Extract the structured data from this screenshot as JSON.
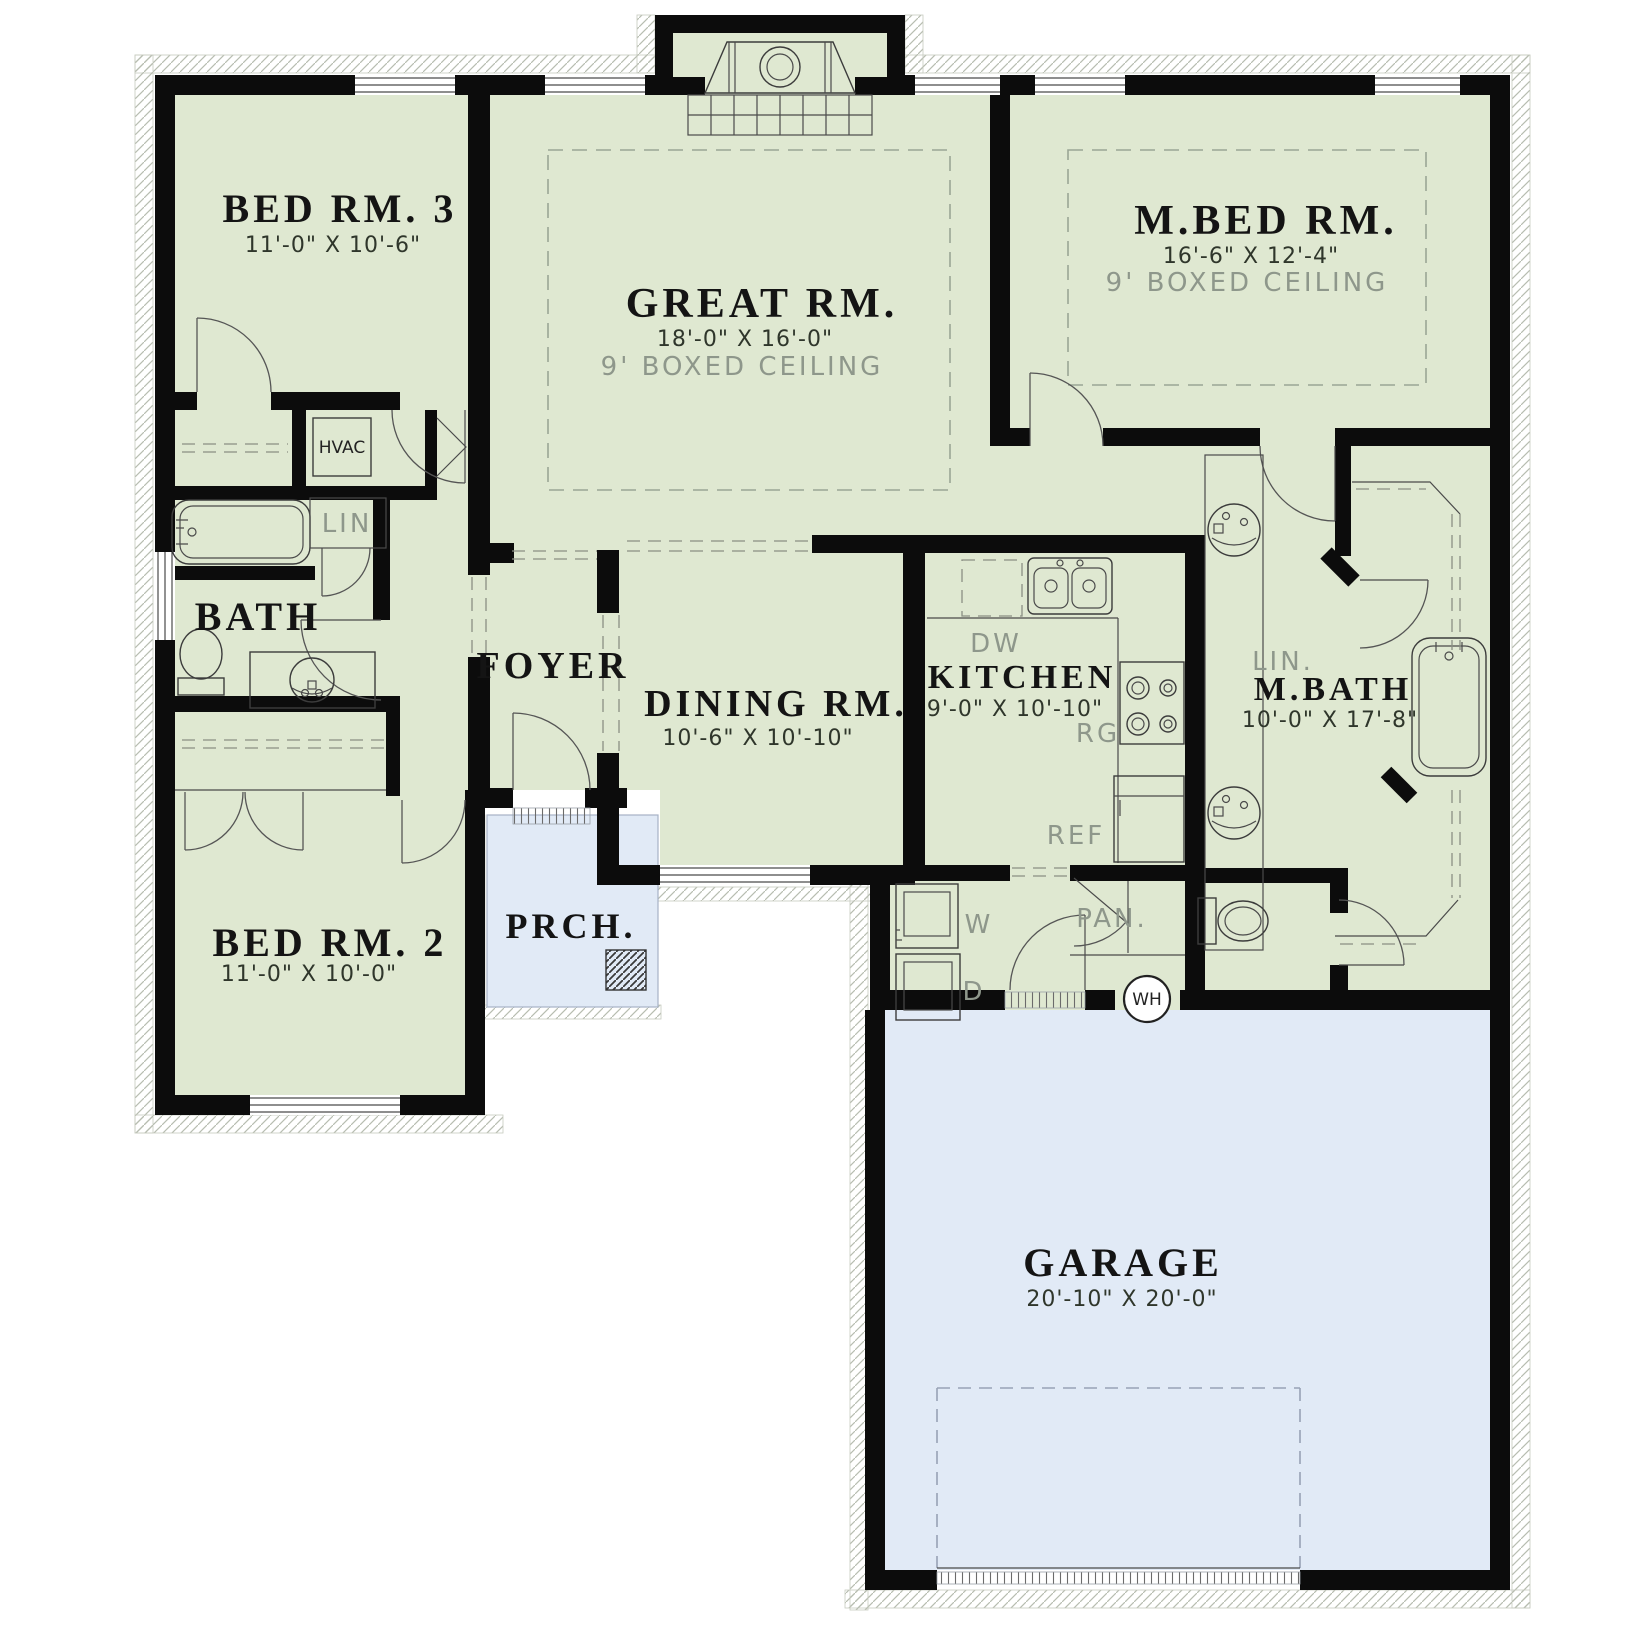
{
  "plan": {
    "colors": {
      "interior_green": "#dfe8d1",
      "exterior_blue": "#e1eaf6",
      "wall_black": "#0c0c0c",
      "gray_label": "#8e978b",
      "dashed_ceiling": "#9aa695"
    },
    "rooms": [
      {
        "id": "bed-rm-3",
        "name": "BED RM. 3",
        "dims": "11'-0\" X 10'-6\""
      },
      {
        "id": "great-rm",
        "name": "GREAT RM.",
        "dims": "18'-0\" X 16'-0\"",
        "ceiling": "9' BOXED CEILING"
      },
      {
        "id": "m-bed-rm",
        "name": "M.BED RM.",
        "dims": "16'-6\" X 12'-4\"",
        "ceiling": "9' BOXED CEILING"
      },
      {
        "id": "bath",
        "name": "BATH"
      },
      {
        "id": "foyer",
        "name": "FOYER"
      },
      {
        "id": "dining-rm",
        "name": "DINING RM.",
        "dims": "10'-6\" X 10'-10\""
      },
      {
        "id": "kitchen",
        "name": "KITCHEN",
        "dims": "9'-0\" X 10'-10\""
      },
      {
        "id": "m-bath",
        "name": "M.BATH",
        "dims": "10'-0\" X 17'-8\""
      },
      {
        "id": "bed-rm-2",
        "name": "BED RM. 2",
        "dims": "11'-0\" X 10'-0\""
      },
      {
        "id": "porch",
        "name": "PRCH."
      },
      {
        "id": "garage",
        "name": "GARAGE",
        "dims": "20'-10\" X 20'-0\""
      }
    ],
    "labels": {
      "hvac": "HVAC",
      "linen_hall": "LIN",
      "linen_master": "LIN.",
      "dishwasher": "DW",
      "range": "RG",
      "refrigerator": "REF",
      "washer": "W",
      "dryer": "D",
      "pantry": "PAN.",
      "water_heater": "WH"
    }
  }
}
